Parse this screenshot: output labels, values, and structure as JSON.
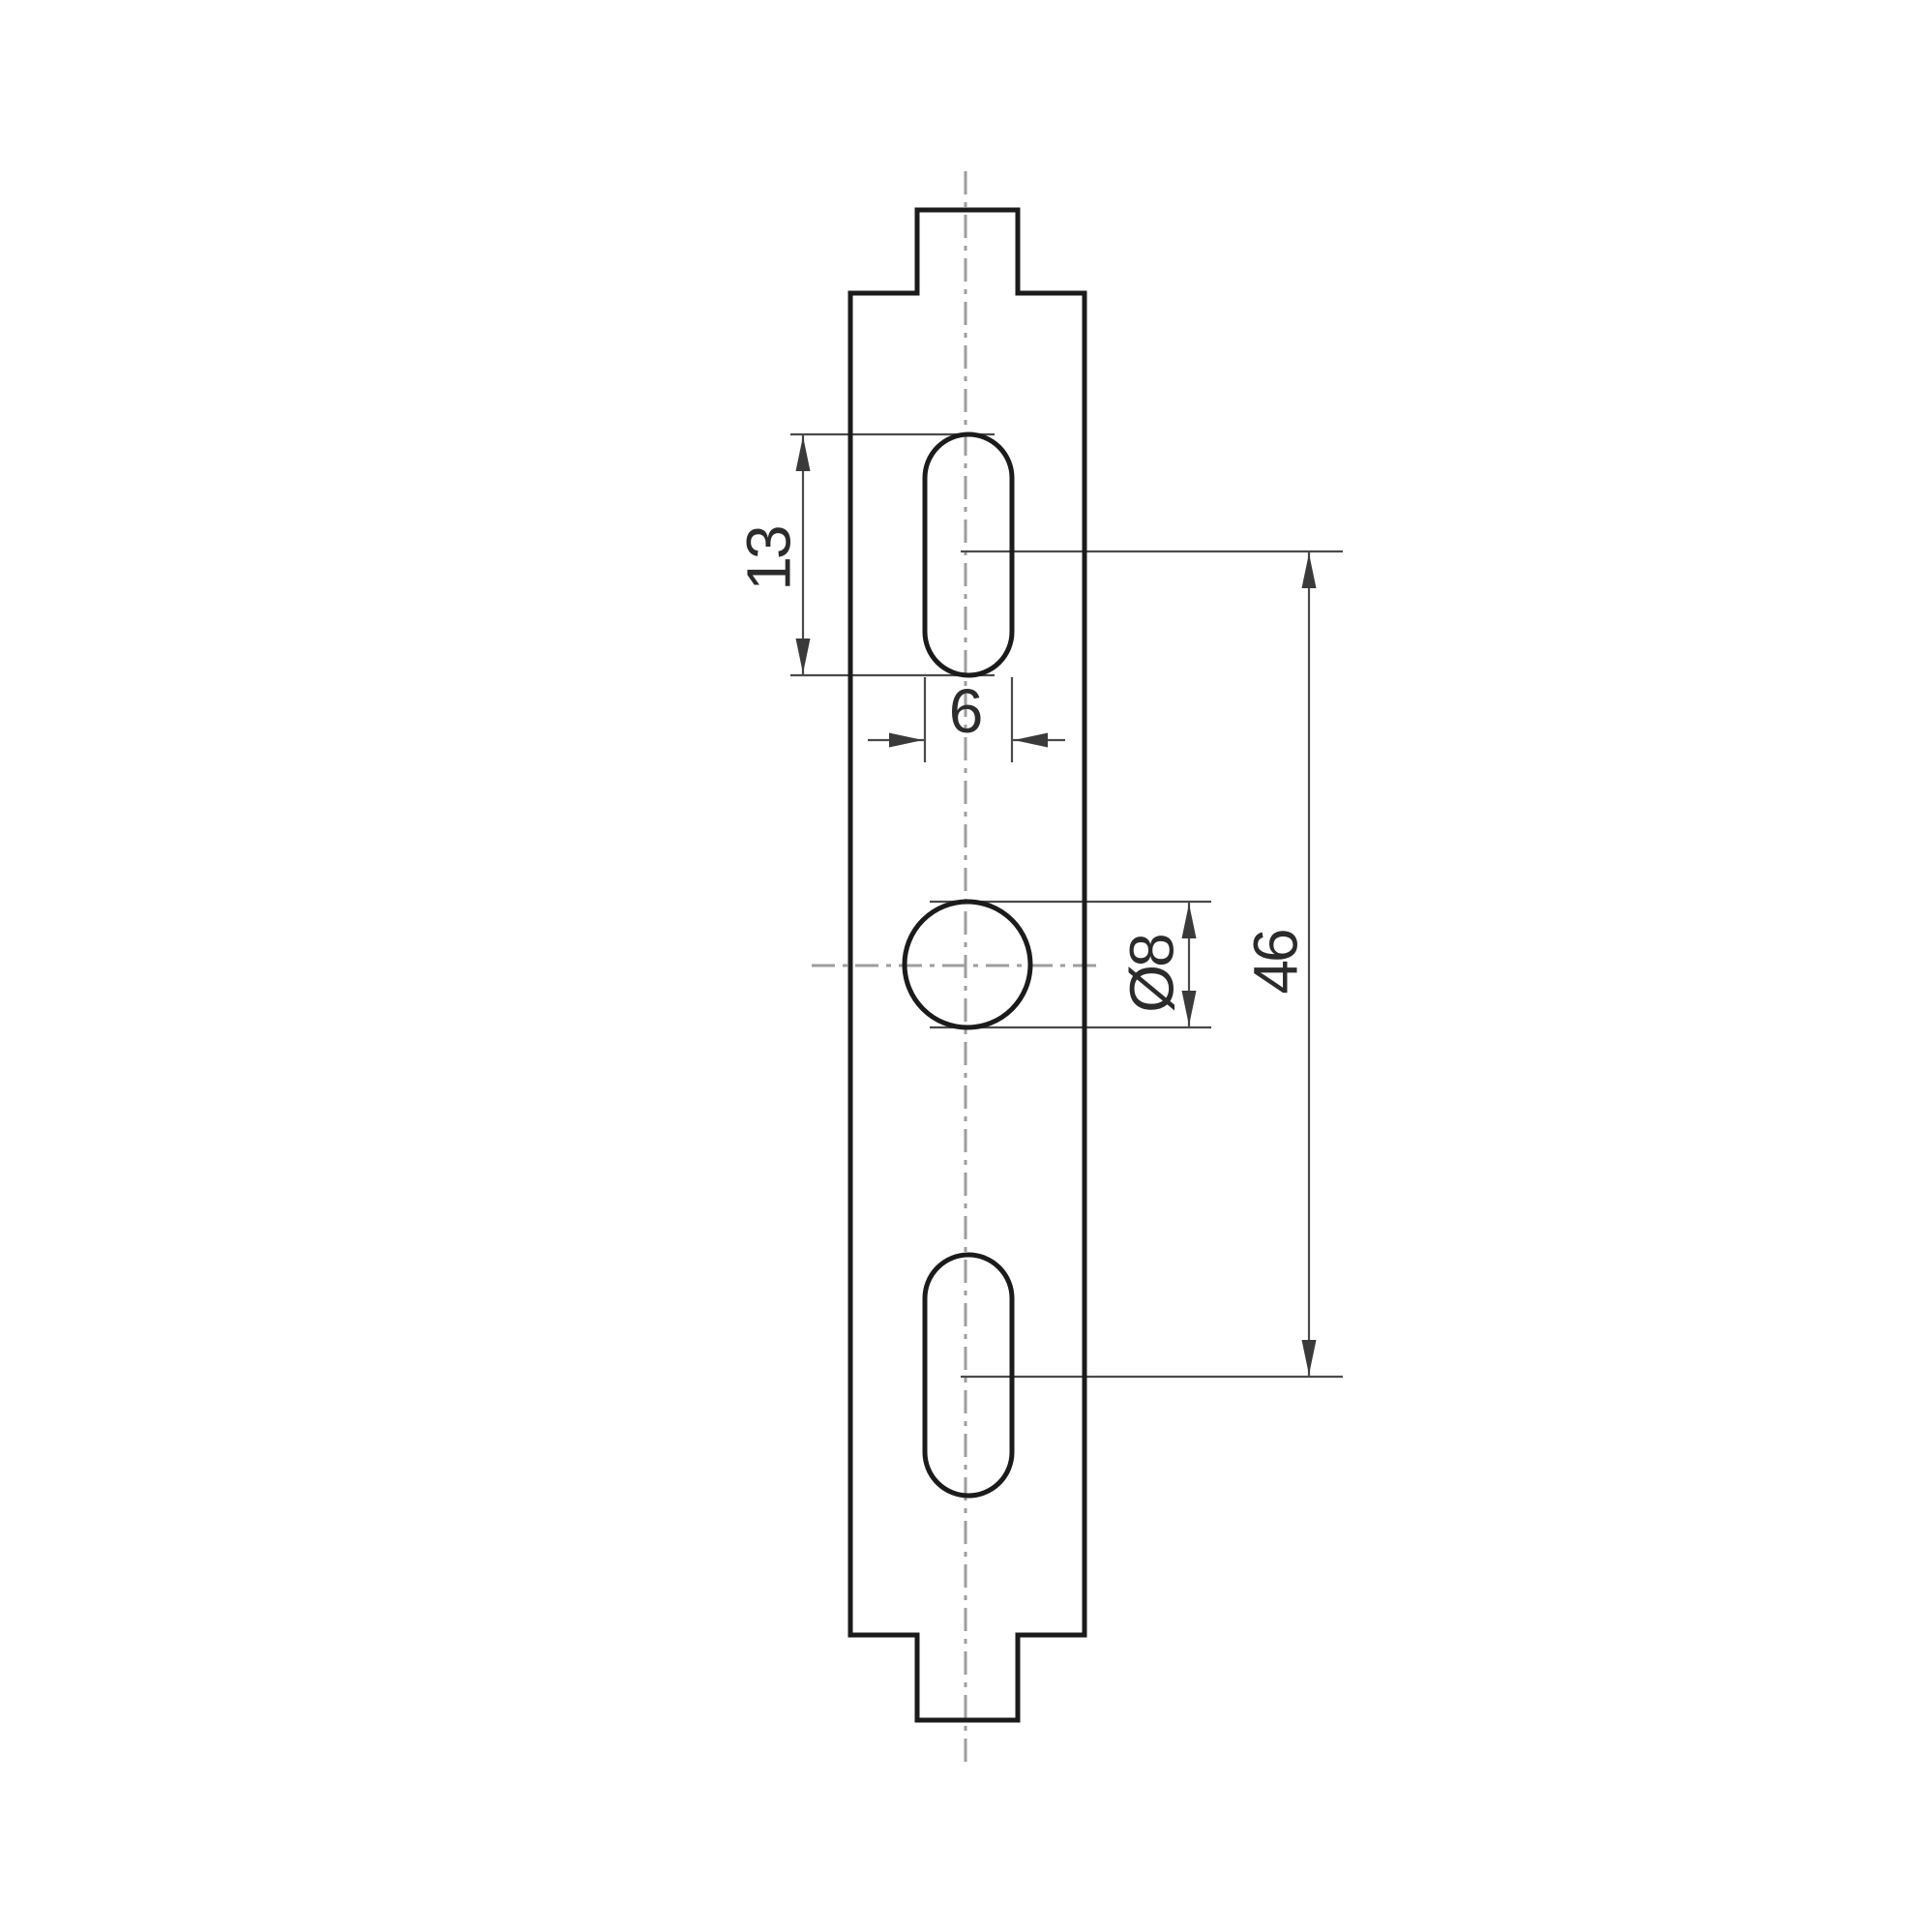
{
  "drawing": {
    "kind": "technical-dimension-drawing",
    "background": "#ffffff",
    "colors": {
      "outline": "#1b1b1b",
      "thin_line": "#4a4a4a",
      "dim_tail": "#8c8c8c",
      "centerline": "#9e9e9e",
      "arrow": "#3a3a3a",
      "text": "#2b2b2b"
    },
    "dimensions": {
      "slot_length": {
        "label": "13"
      },
      "slot_width": {
        "label": "6"
      },
      "hole_diameter": {
        "label": "Ø8"
      },
      "hole_spacing": {
        "label": "46"
      }
    }
  }
}
